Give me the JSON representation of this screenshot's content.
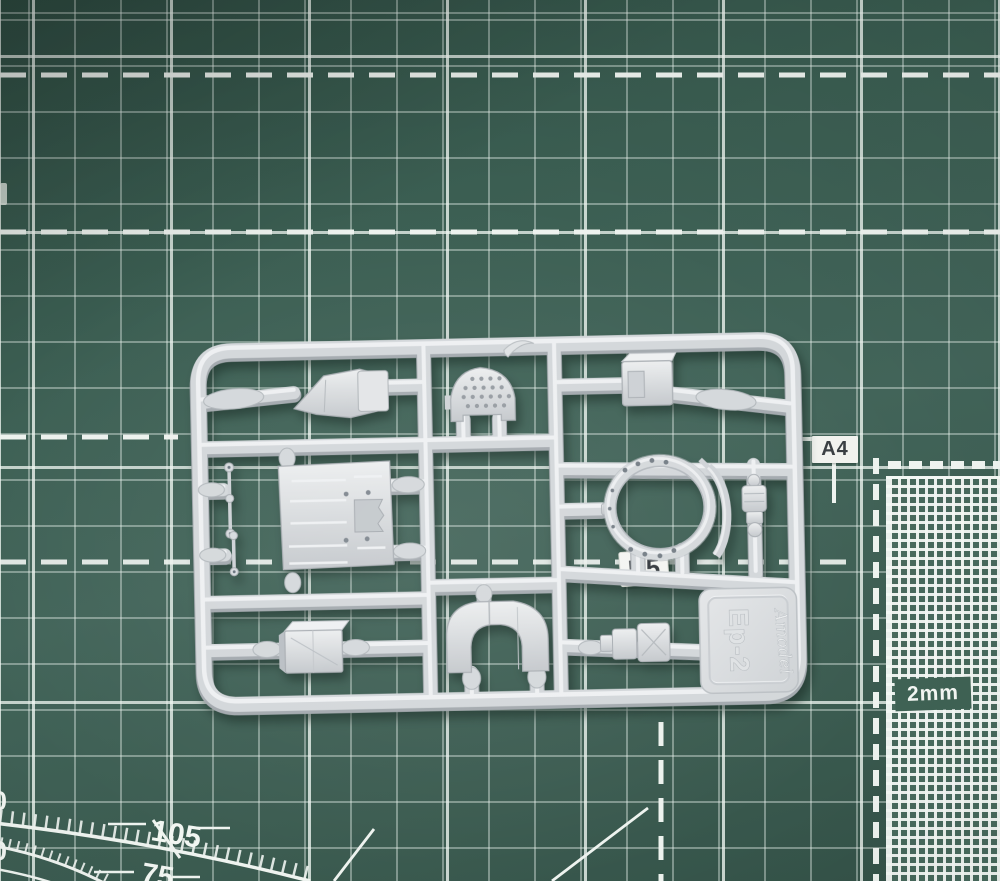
{
  "mat": {
    "labels": {
      "paper_size": "A4",
      "fine_grid_scale": "2mm"
    },
    "protractor": {
      "outer_angle": "105",
      "inner_angle": "75",
      "edge_digit_top": "0",
      "edge_digit_bottom": "0"
    },
    "colors": {
      "surface_green": "#3b5e52",
      "grid_line_white": "#edf2ee"
    }
  },
  "sprue": {
    "runner_sticker_label": "B5",
    "tag": {
      "part_code": "Ep-2",
      "brand_logo": "Amodel"
    },
    "colors": {
      "plastic_gray": "#d3d7da"
    }
  }
}
